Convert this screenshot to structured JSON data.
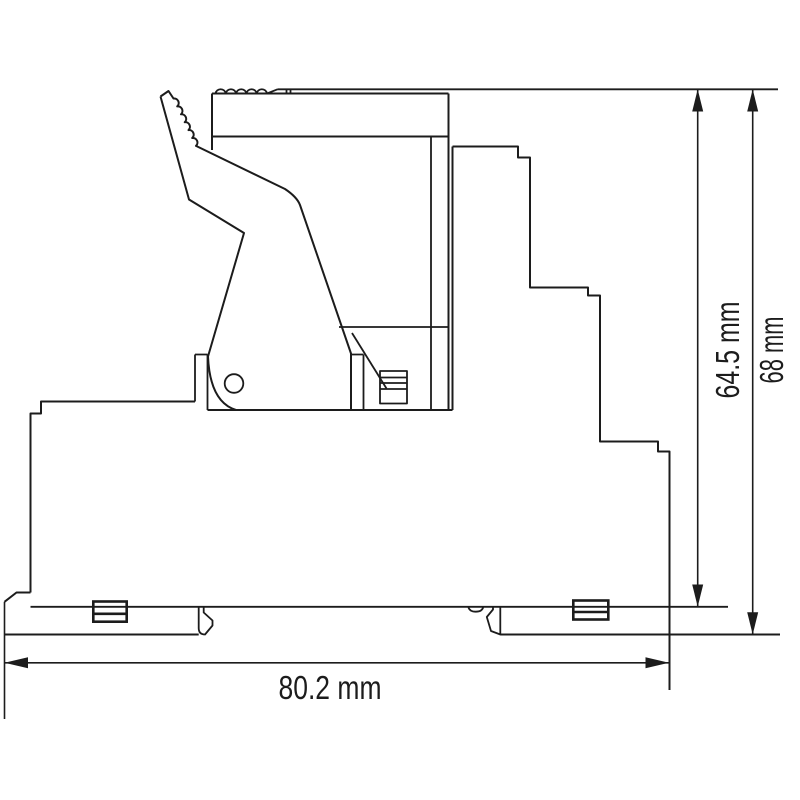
{
  "drawing": {
    "type": "technical-dimension-drawing",
    "subject": "din-rail-relay-module-side-view",
    "background_color": "#ffffff",
    "line_color": "#1c1c1c",
    "dimensions": {
      "height_to_rail": {
        "label": "64.5 mm",
        "orientation": "vertical"
      },
      "height_overall": {
        "label": "68 mm",
        "orientation": "vertical"
      },
      "width_overall": {
        "label": "80.2 mm",
        "orientation": "horizontal"
      }
    }
  }
}
